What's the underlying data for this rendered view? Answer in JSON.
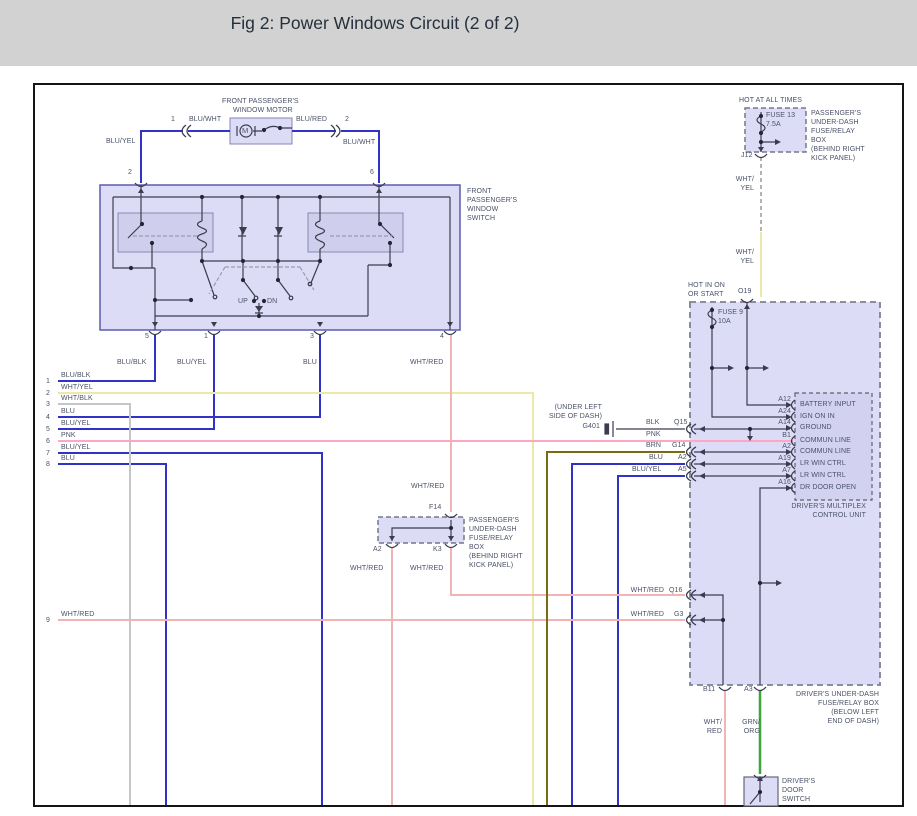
{
  "title": "Fig 2: Power Windows Circuit (2 of 2)",
  "colors": {
    "titlebar_bg": "#d2d2d2",
    "wire_blue": "#3231c8",
    "wire_wht_yel": "#ece9a8",
    "wire_wht_blk": "#c6c6c6",
    "wire_pnk": "#ffa6c2",
    "wire_wht_red": "#f0b4b4",
    "wire_brn": "#7a6a14",
    "wire_grn_org": "#3ea53e",
    "box_fill": "#dcdcf6",
    "box_border": "#5c5cae",
    "symbol": "#3c3c50",
    "label_text": "#4a5268"
  },
  "motor": {
    "name1": "FRONT PASSENGER'S",
    "name2": "WINDOW MOTOR",
    "m": "M",
    "pin_left": "1",
    "pin_right": "2",
    "wire_left": "BLU/WHT",
    "wire_right": "BLU/RED",
    "wire_down_left": "BLU/YEL",
    "wire_down_right": "BLU/WHT",
    "switch_pin_left": "2",
    "switch_pin_right": "6"
  },
  "swbox": {
    "label1": "FRONT",
    "label2": "PASSENGER'S",
    "label3": "WINDOW",
    "label4": "SWITCH",
    "up": "UP",
    "dn": "DN",
    "pin5": "5",
    "pin1": "1",
    "pin3": "3",
    "pin4": "4",
    "wire5": "BLU/BLK",
    "wire1": "BLU/YEL",
    "wire3": "BLU",
    "wire4": "WHT/RED"
  },
  "rows": [
    {
      "num": "1",
      "label": "BLU/BLK"
    },
    {
      "num": "2",
      "label": "WHT/YEL"
    },
    {
      "num": "3",
      "label": "WHT/BLK"
    },
    {
      "num": "4",
      "label": "BLU"
    },
    {
      "num": "5",
      "label": "BLU/YEL"
    },
    {
      "num": "6",
      "label": "PNK"
    },
    {
      "num": "7",
      "label": "BLU/YEL"
    },
    {
      "num": "8",
      "label": "BLU"
    },
    {
      "num": "9",
      "label": "WHT/RED"
    }
  ],
  "ground": {
    "loc1": "(UNDER LEFT",
    "loc2": "SIDE OF DASH)",
    "name": "G401"
  },
  "mid": {
    "blk": "BLK",
    "q15": "Q15",
    "pnk": "PNK",
    "brn": "BRN",
    "g14": "G14",
    "blu": "BLU",
    "a2": "A2",
    "bluyel": "BLU/YEL",
    "a5": "A5"
  },
  "fuse13": {
    "hot": "HOT AT ALL TIMES",
    "name": "FUSE 13",
    "amps": "7.5A",
    "conn": "J12",
    "l1": "PASSENGER'S",
    "l2": "UNDER-DASH",
    "l3": "FUSE/RELAY",
    "l4": "BOX",
    "l5": "(BEHIND RIGHT",
    "l6": "KICK PANEL)",
    "w1a": "WHT/",
    "w1b": "YEL",
    "w2a": "WHT/",
    "w2b": "YEL"
  },
  "midbox": {
    "wtop": "WHT/RED",
    "conn": "F14",
    "a2": "A2",
    "k3": "K3",
    "wbl": "WHT/RED",
    "wbr": "WHT/RED",
    "l1": "PASSENGER'S",
    "l2": "UNDER-DASH",
    "l3": "FUSE/RELAY",
    "l4": "BOX",
    "l5": "(BEHIND RIGHT",
    "l6": "KICK PANEL)"
  },
  "driver": {
    "hot1": "HOT IN ON",
    "hot2": "OR START",
    "conn": "O19",
    "fuse": "FUSE 9",
    "amps": "10A",
    "q16w": "WHT/RED",
    "q16": "Q16",
    "g3w": "WHT/RED",
    "g3": "G3",
    "b11": "B11",
    "a3": "A3",
    "wb1": "WHT/",
    "wb2": "RED",
    "wg1": "GRN/",
    "wg2": "ORG",
    "l1": "DRIVER'S UNDER-DASH",
    "l2": "FUSE/RELAY BOX",
    "l3": "(BELOW LEFT",
    "l4": "END OF DASH)"
  },
  "mux": {
    "pins": [
      {
        "pin": "A12",
        "name": "BATTERY INPUT"
      },
      {
        "pin": "A24",
        "name": "IGN ON IN"
      },
      {
        "pin": "A14",
        "name": "GROUND"
      },
      {
        "pin": "B1",
        "name": "COMMUN LINE"
      },
      {
        "pin": "A2",
        "name": "COMMUN LINE"
      },
      {
        "pin": "A19",
        "name": "LR WIN CTRL"
      },
      {
        "pin": "A7",
        "name": "LR WIN CTRL"
      },
      {
        "pin": "A16",
        "name": "DR DOOR OPEN"
      }
    ],
    "l1": "DRIVER'S MULTIPLEX",
    "l2": "CONTROL UNIT"
  },
  "door": {
    "l1": "DRIVER'S",
    "l2": "DOOR",
    "l3": "SWITCH"
  }
}
